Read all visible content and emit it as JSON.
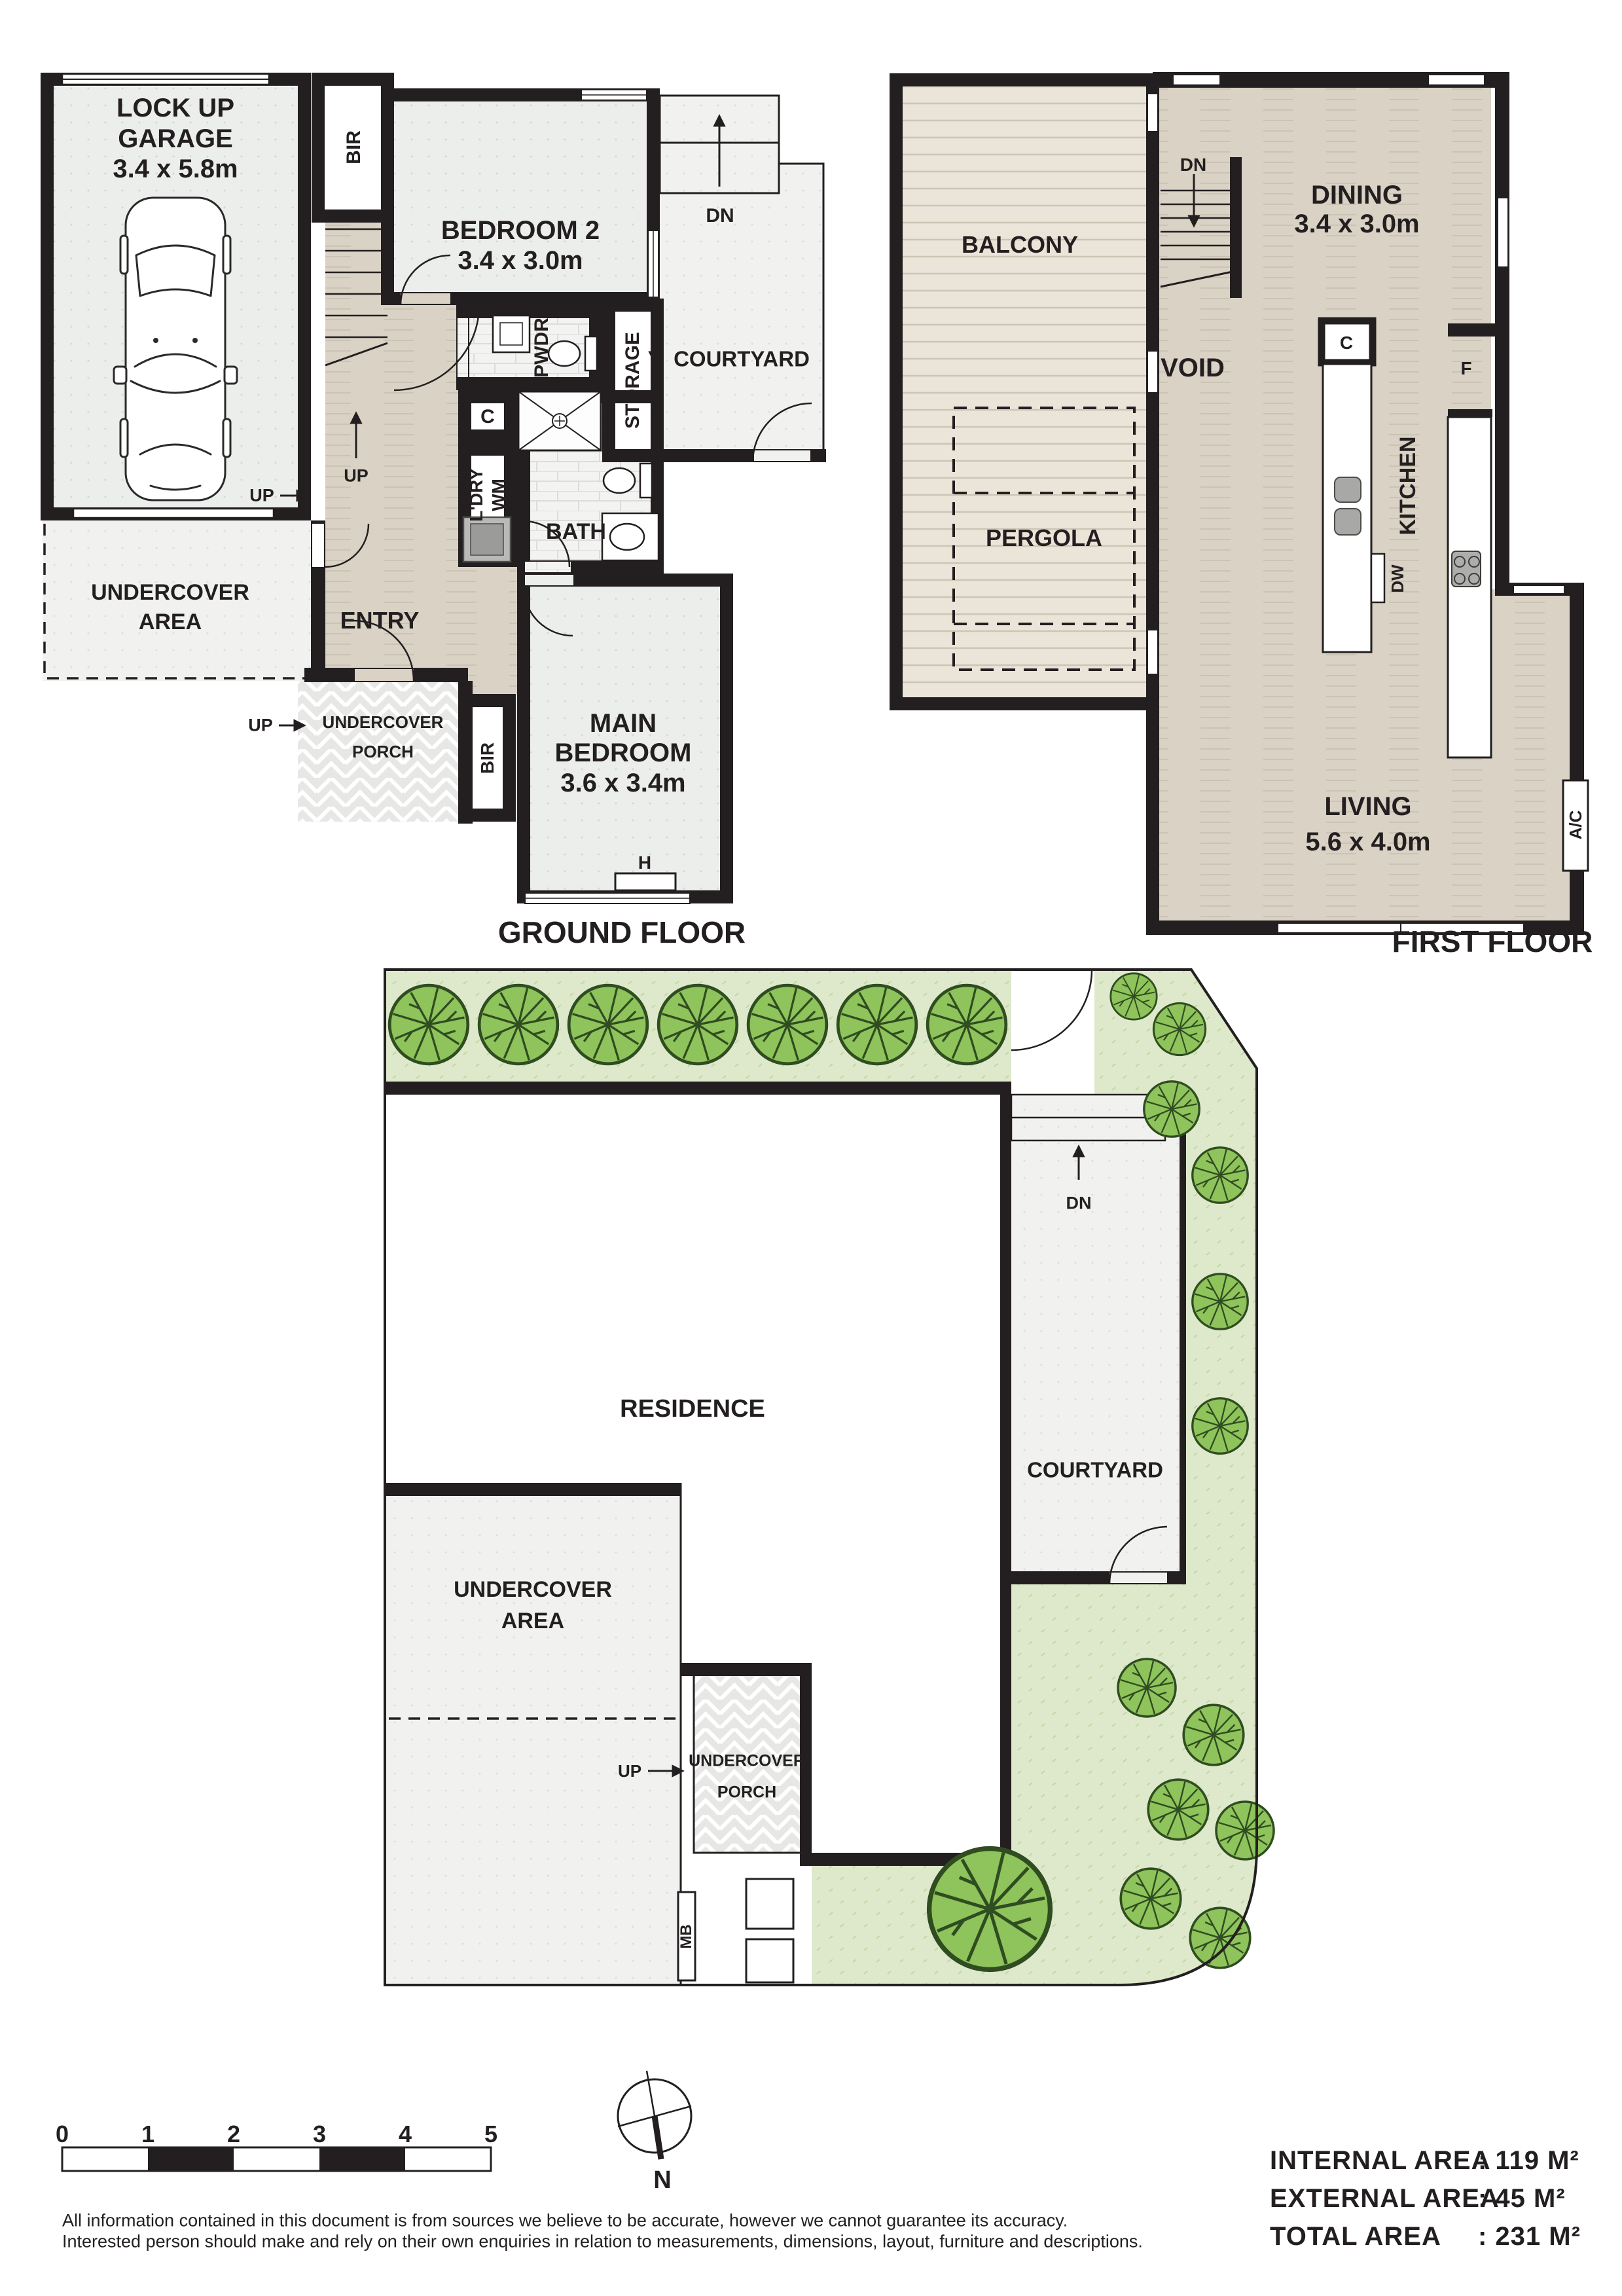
{
  "ground_floor": {
    "title": "GROUND FLOOR",
    "garage": {
      "line1": "LOCK UP",
      "line2": "GARAGE",
      "dims": "3.4 x 5.8m"
    },
    "bir": "BIR",
    "bedroom2": {
      "name": "BEDROOM 2",
      "dims": "3.4 x 3.0m"
    },
    "courtyard": "COURTYARD",
    "pwdr": "PWDR",
    "storage": "STORAGE",
    "cupboard": "C",
    "laundry": "L'DRY",
    "washing_machine": "WM",
    "bath": "BATH",
    "entry": "ENTRY",
    "undercover_area": {
      "line1": "UNDERCOVER",
      "line2": "AREA"
    },
    "porch": {
      "line1": "UNDERCOVER",
      "line2": "PORCH"
    },
    "main_bedroom": {
      "line1": "MAIN",
      "line2": "BEDROOM",
      "dims": "3.6 x 3.4m"
    },
    "heater": "H",
    "up": "UP",
    "dn": "DN"
  },
  "first_floor": {
    "title": "FIRST FLOOR",
    "balcony": "BALCONY",
    "pergola": "PERGOLA",
    "void": "VOID",
    "dn": "DN",
    "dining": {
      "name": "DINING",
      "dims": "3.4 x 3.0m"
    },
    "kitchen": "KITCHEN",
    "cupboard": "C",
    "fridge": "F",
    "dishwasher": "DW",
    "living": {
      "name": "LIVING",
      "dims": "5.6 x 4.0m"
    },
    "ac": "A/C"
  },
  "site_plan": {
    "residence": "RESIDENCE",
    "courtyard": "COURTYARD",
    "dn": "DN",
    "up": "UP",
    "undercover_area": {
      "line1": "UNDERCOVER",
      "line2": "AREA"
    },
    "porch": {
      "line1": "UNDERCOVER",
      "line2": "PORCH"
    },
    "meter_box": "MB"
  },
  "legend": {
    "scale_ticks": [
      "0",
      "1",
      "2",
      "3",
      "4",
      "5"
    ],
    "north": "N",
    "disclaimer_line1": "All information contained in this document is from sources we believe to be accurate, however we cannot guarantee its accuracy.",
    "disclaimer_line2": "Interested person should make and rely on their own enquiries in relation to measurements, dimensions, layout, furniture and descriptions.",
    "areas": [
      {
        "label": "INTERNAL AREA",
        "value": ": 119 M²"
      },
      {
        "label": "EXTERNAL AREA",
        "value": ": 45 M²"
      },
      {
        "label": "TOTAL AREA",
        "value": ": 231 M²"
      }
    ]
  },
  "colors": {
    "wall": "#231f20",
    "floor_tan": "#d9d2c5",
    "floor_gray": "#eceeec",
    "deck": "#eae4d9",
    "lawn": "#dde9ca",
    "tree": "#8fc35b"
  }
}
